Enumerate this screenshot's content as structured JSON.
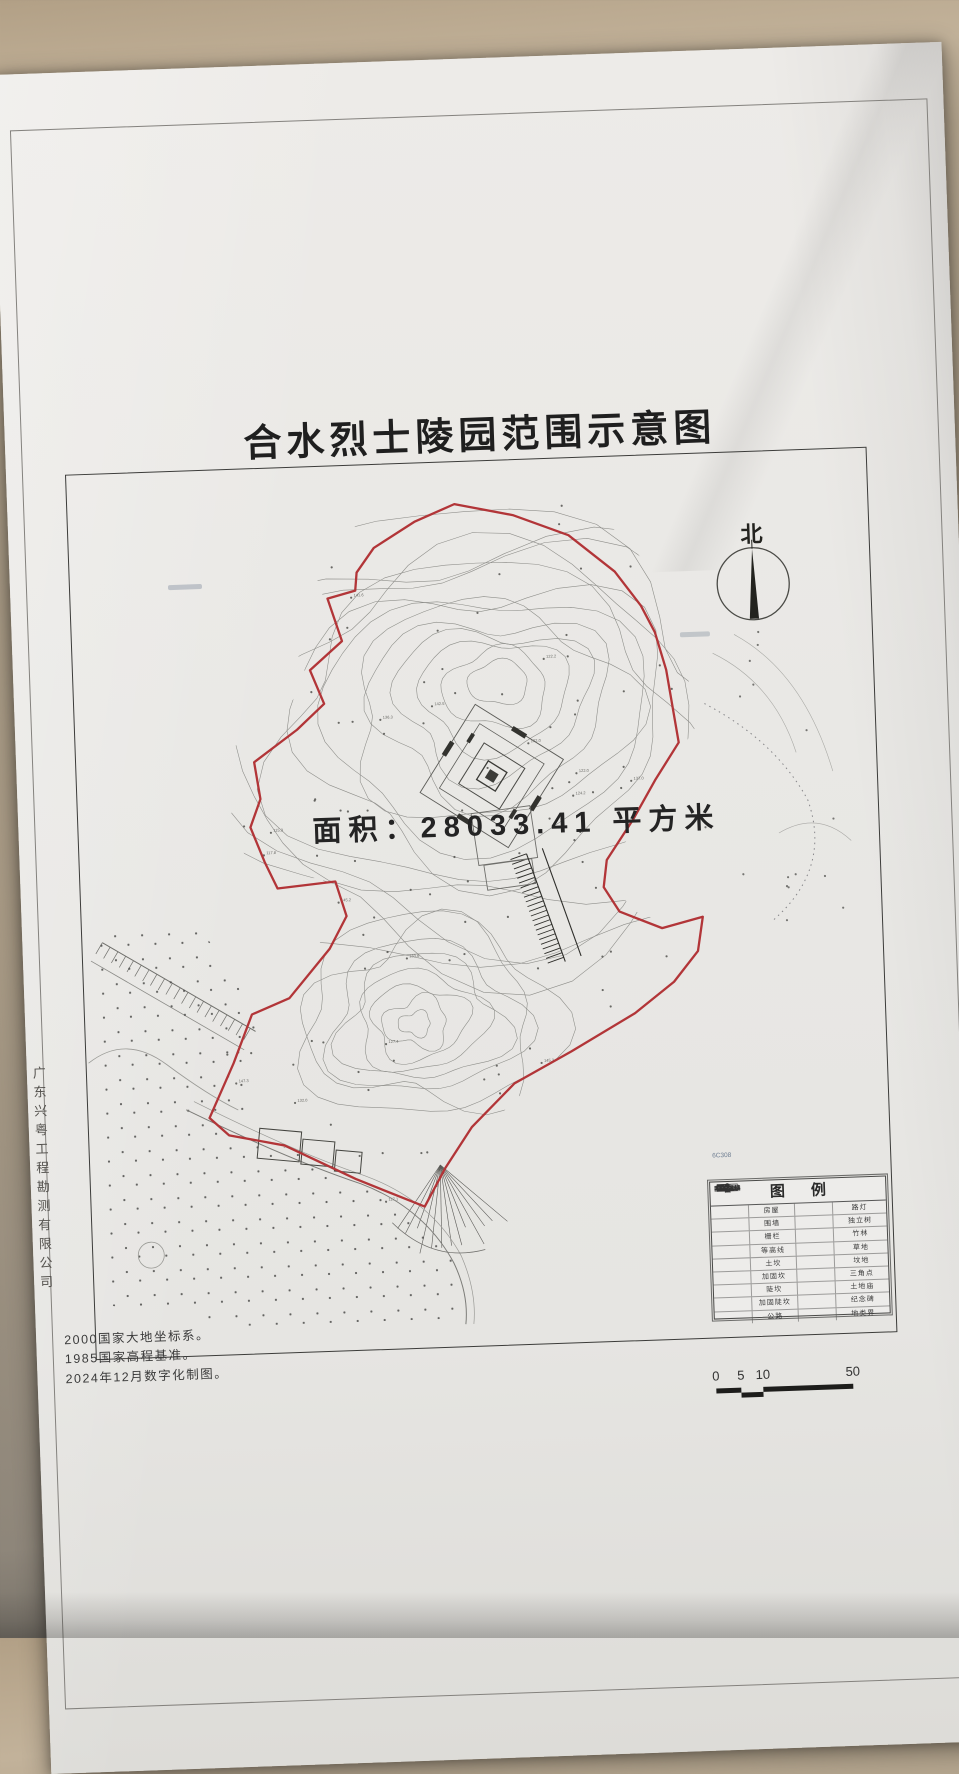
{
  "photo": {
    "desk_color": "#b3a189",
    "paper_color": "#e9e8e5"
  },
  "title": "合水烈士陵园范围示意图",
  "map": {
    "area_label": "面积：28033.41 平方米",
    "north_label": "北",
    "station_label": "6C308",
    "boundary_color": "#b23538"
  },
  "legend": {
    "title": "图例",
    "rows": [
      {
        "left_label": "房屋",
        "right_label": "路灯"
      },
      {
        "left_label": "围墙",
        "right_label": "独立树"
      },
      {
        "left_label": "栅栏",
        "right_label": "竹林"
      },
      {
        "left_label": "等高线",
        "right_label": "草地"
      },
      {
        "left_label": "土坎",
        "right_label": "坟地"
      },
      {
        "left_label": "加固坎",
        "right_label": "三角点"
      },
      {
        "left_label": "陡坎",
        "right_label": "土地庙"
      },
      {
        "left_label": "加固陡坎",
        "right_label": "纪念碑"
      },
      {
        "left_label": "公路",
        "right_label": "地类界"
      }
    ]
  },
  "scale_bar": {
    "ticks": [
      "0",
      "5",
      "10",
      "50"
    ]
  },
  "notes": {
    "line1": "2000国家大地坐标系。",
    "line2": "1985国家高程基准。",
    "line3": "2024年12月数字化制图。"
  },
  "surveyor": "广东兴粤工程勘测有限公司"
}
